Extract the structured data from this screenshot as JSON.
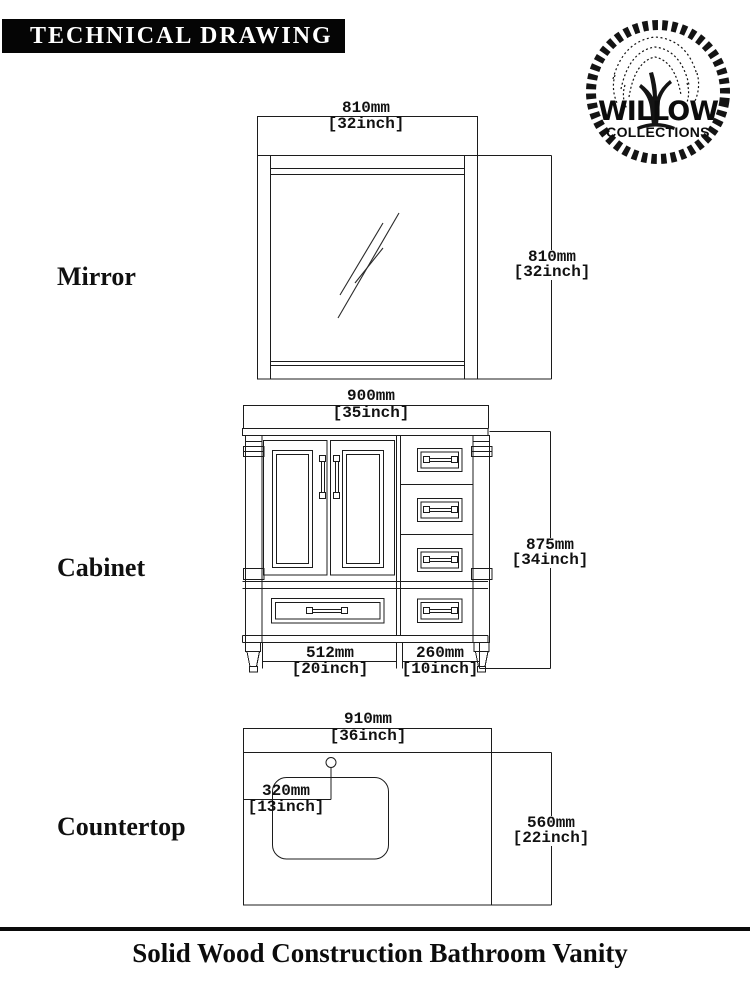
{
  "header": {
    "title": "TECHNICAL DRAWING"
  },
  "logo": {
    "brand": "WILLOW",
    "tagline": "COLLECTIONS"
  },
  "sections": {
    "mirror": {
      "label": "Mirror",
      "dims": {
        "width": {
          "mm": "810mm",
          "inch": "[32inch]"
        },
        "height": {
          "mm": "810mm",
          "inch": "[32inch]"
        }
      }
    },
    "cabinet": {
      "label": "Cabinet",
      "dims": {
        "width": {
          "mm": "900mm",
          "inch": "[35inch]"
        },
        "height": {
          "mm": "875mm",
          "inch": "[34inch]"
        },
        "doors_width": {
          "mm": "512mm",
          "inch": "[20inch]"
        },
        "drawers_width": {
          "mm": "260mm",
          "inch": "[10inch]"
        }
      }
    },
    "countertop": {
      "label": "Countertop",
      "dims": {
        "width": {
          "mm": "910mm",
          "inch": "[36inch]"
        },
        "depth": {
          "mm": "560mm",
          "inch": "[22inch]"
        },
        "faucet_offset": {
          "mm": "320mm",
          "inch": "[13inch]"
        }
      }
    }
  },
  "footer": {
    "title": "Solid Wood Construction Bathroom Vanity"
  },
  "colors": {
    "ink": "#1c1c1c",
    "paper": "#ffffff"
  }
}
